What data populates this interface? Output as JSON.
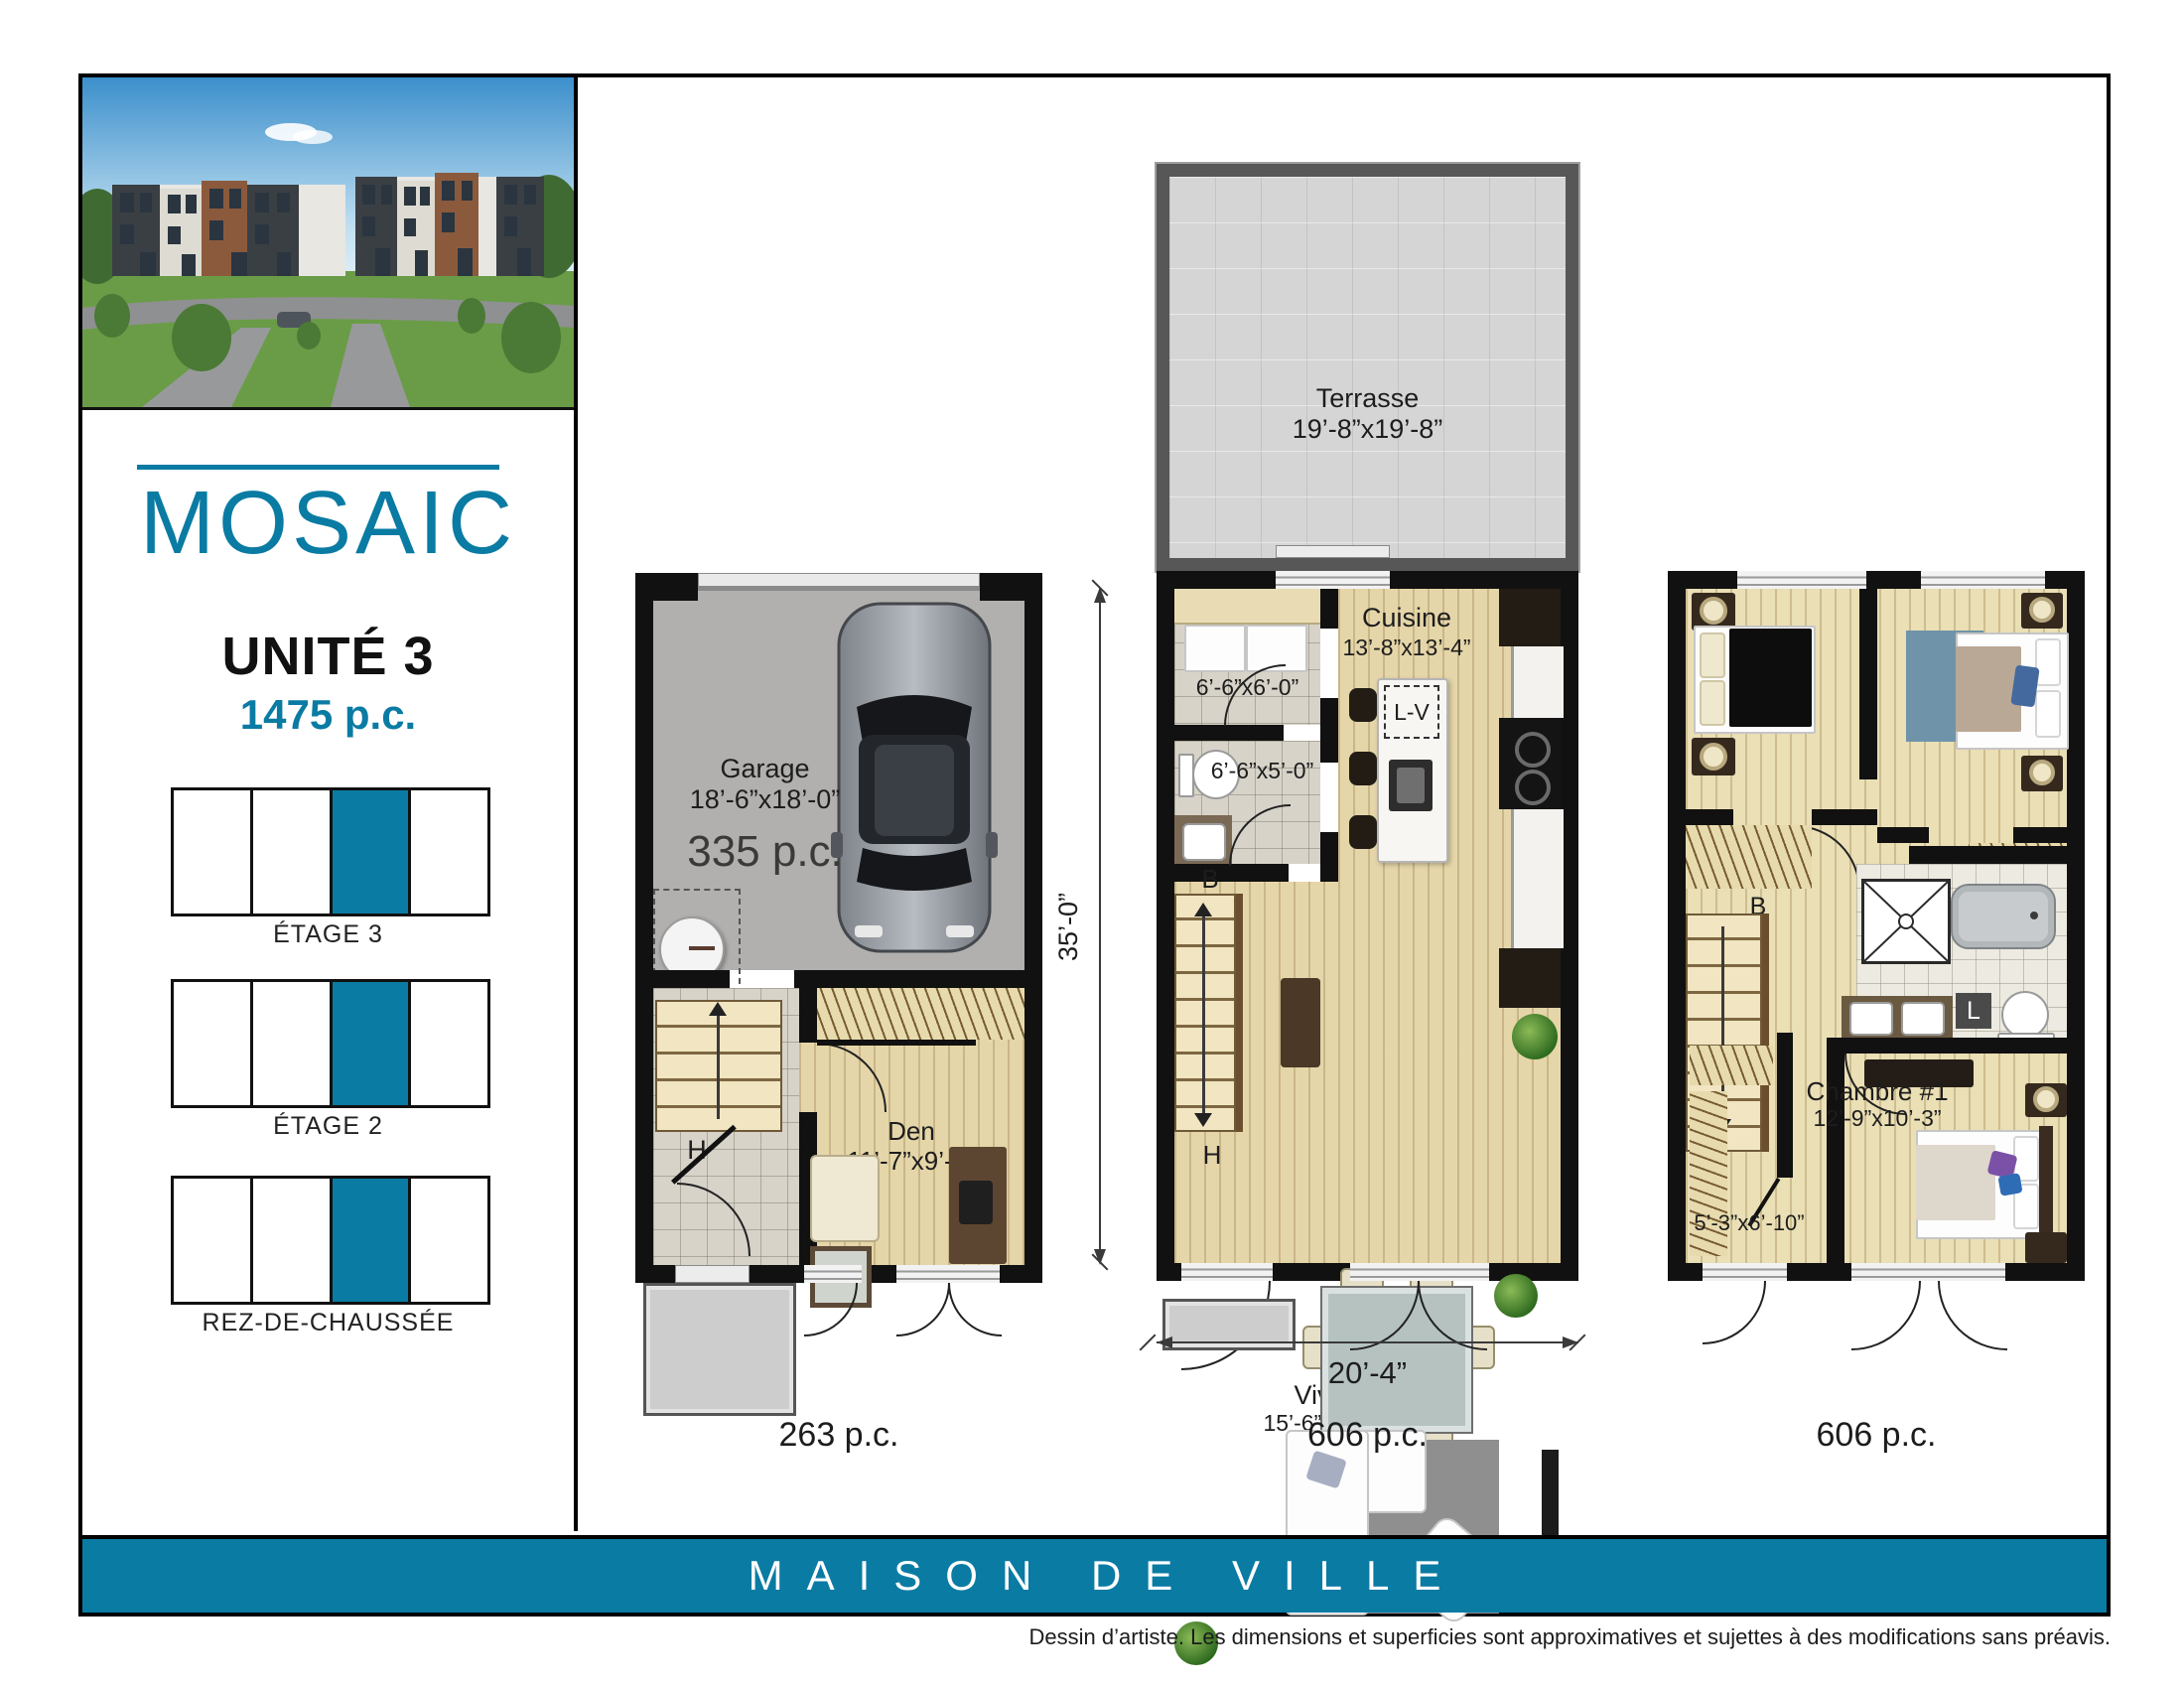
{
  "colors": {
    "accent": "#0a7ba3"
  },
  "sidebar": {
    "logo": "MOSAIC",
    "unit_title": "UNITÉ 3",
    "unit_area": "1475 p.c.",
    "floor_diagrams": [
      {
        "label": "ÉTAGE 3",
        "cells": 4,
        "highlighted_cell": 2
      },
      {
        "label": "ÉTAGE 2",
        "cells": 4,
        "highlighted_cell": 2
      },
      {
        "label": "REZ-DE-CHAUSSÉE",
        "cells": 4,
        "highlighted_cell": 2
      }
    ]
  },
  "plans": {
    "rdc": {
      "area_label": "263 p.c.",
      "garage_name": "Garage",
      "garage_dims": "18’-6”x18’-0”",
      "garage_area": "335 p.c.",
      "den_name": "Den",
      "den_dims": "11’-7”x9’-2”",
      "stair_label": "H"
    },
    "etage2": {
      "area_label": "606 p.c.",
      "terrasse_name": "Terrasse",
      "terrasse_dims": "19’-8”x19’-8”",
      "cuisine_name": "Cuisine",
      "cuisine_dims": "13’-8”x13’-4”",
      "vivoir_name": "Vivoir",
      "vivoir_dims": "15’-6”x18’-7”",
      "closet_dims": "6’-6”x6’-0”",
      "powder_dims": "6’-6”x5’-0”",
      "dishwasher_label": "L-V",
      "stair_label_up": "B",
      "stair_label_down": "H",
      "dim_height": "35’-0”",
      "dim_width": "20’-4”"
    },
    "etage3": {
      "area_label": "606 p.c.",
      "chambre_name": "Chambre #1",
      "chambre_dims": "12’-9”x10’-3”",
      "walkin_dims": "5’-3”x6’-10”",
      "stair_label": "B",
      "linen_label": "L"
    }
  },
  "footer": {
    "banner": "MAISON DE VILLE",
    "disclaimer": "Dessin d’artiste. Les dimensions et superficies sont approximatives et sujettes à des modifications sans préavis."
  }
}
